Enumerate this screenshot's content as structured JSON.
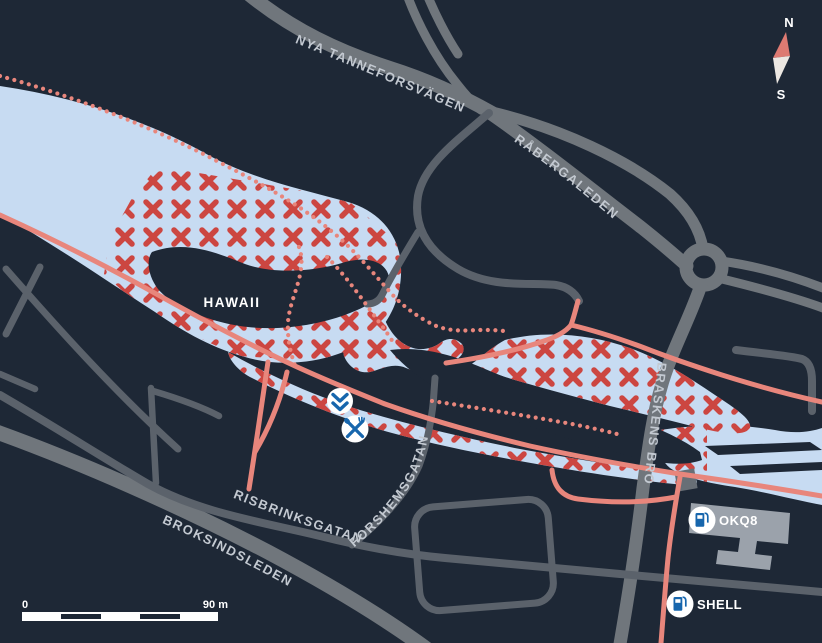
{
  "streets": {
    "nya_tanneforsvagen": "NYA TANNEFORSVÄGEN",
    "rabergaleden": "RÅBERGALEDEN",
    "braskens_bro": "BRASKENS BRO",
    "risbrinksgatan": "RISBRINKSGATAN",
    "forshemsgatan": "FORSHEMSGATAN",
    "broksindsleden": "BROKSINDSLEDEN"
  },
  "places": {
    "hawaii": "HAWAII"
  },
  "poi": {
    "okq8": {
      "label": "OKQ8",
      "icon": "fuel-pump-icon"
    },
    "shell": {
      "label": "SHELL",
      "icon": "fuel-pump-icon"
    },
    "rapids_marker": {
      "icon": "double-chevron-down-icon"
    },
    "food_marker": {
      "icon": "crossed-utensils-icon"
    }
  },
  "compass": {
    "north": "N",
    "south": "S"
  },
  "scale_bar": {
    "start_label": "0",
    "end_label": "90 m"
  },
  "legend": {
    "fishing_area_symbol": "red-x-hatch",
    "trail_symbol": "dotted-line"
  },
  "colors": {
    "background": "#1e2836",
    "water": "#c7dbf2",
    "fishing-mark": "#cc4641",
    "trail": "#e8867c",
    "road-major": "#70767c",
    "road-minor": "#5b626b",
    "street-label": "#c3c9d1",
    "poi-blue": "#1766ad",
    "building": "#9ba2ab",
    "compass-red": "#dd7a72"
  }
}
